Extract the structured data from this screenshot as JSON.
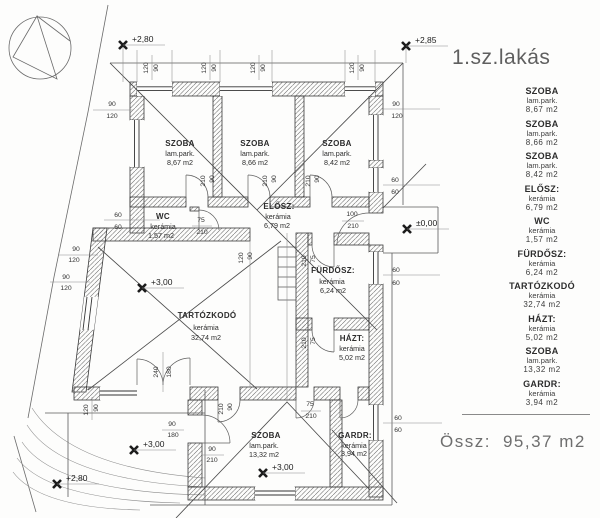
{
  "title": "1.sz.lakás",
  "total_label": "Össz:",
  "total_value": "95,37 m2",
  "legend": {
    "items": [
      {
        "name": "SZOBA",
        "material": "lam.park.",
        "area": "8,67 m2"
      },
      {
        "name": "SZOBA",
        "material": "lam.park.",
        "area": "8,66 m2"
      },
      {
        "name": "SZOBA",
        "material": "lam.park.",
        "area": "8,42 m2"
      },
      {
        "name": "ELŐSZ:",
        "material": "kerámia",
        "area": "6,79 m2"
      },
      {
        "name": "WC",
        "material": "kerámia",
        "area": "1,57 m2"
      },
      {
        "name": "FÜRDŐSZ:",
        "material": "kerámia",
        "area": "6,24 m2"
      },
      {
        "name": "TARTÓZKODÓ",
        "material": "kerámia",
        "area": "32,74 m2"
      },
      {
        "name": "HÁZT:",
        "material": "kerámia",
        "area": "5,02 m2"
      },
      {
        "name": "SZOBA",
        "material": "lam.park.",
        "area": "13,32 m2"
      },
      {
        "name": "GARDR:",
        "material": "kerámia",
        "area": "3,94 m2"
      }
    ]
  },
  "plan": {
    "elevations": [
      {
        "text": "+2,80",
        "x": 123,
        "y": 45
      },
      {
        "text": "+2,85",
        "x": 406,
        "y": 46
      },
      {
        "text": "±0,00",
        "x": 407,
        "y": 229
      },
      {
        "text": "+3,00",
        "x": 142,
        "y": 288
      },
      {
        "text": "+3,00",
        "x": 263,
        "y": 473
      },
      {
        "text": "+3,00",
        "x": 134,
        "y": 450
      },
      {
        "text": "+2,80",
        "x": 57,
        "y": 484
      }
    ],
    "labels": [
      {
        "k": "room-name",
        "t": "SZOBA",
        "x": 180,
        "y": 146
      },
      {
        "k": "room-material",
        "t": "lam.park.",
        "x": 180,
        "y": 156
      },
      {
        "k": "room-area",
        "t": "8,67  m2",
        "x": 180,
        "y": 165
      },
      {
        "k": "room-name",
        "t": "SZOBA",
        "x": 255,
        "y": 146
      },
      {
        "k": "room-material",
        "t": "lam.park.",
        "x": 255,
        "y": 156
      },
      {
        "k": "room-area",
        "t": "8,66  m2",
        "x": 255,
        "y": 165
      },
      {
        "k": "room-name",
        "t": "SZOBA",
        "x": 337,
        "y": 146
      },
      {
        "k": "room-material",
        "t": "lam.park.",
        "x": 337,
        "y": 156
      },
      {
        "k": "room-area",
        "t": "8,42  m2",
        "x": 337,
        "y": 165
      },
      {
        "k": "room-name",
        "t": "WC",
        "x": 163,
        "y": 219
      },
      {
        "k": "room-material",
        "t": "kerámia",
        "x": 163,
        "y": 229
      },
      {
        "k": "room-area",
        "t": "1,57  m2",
        "x": 161,
        "y": 238
      },
      {
        "k": "room-name",
        "t": "ELŐSZ:",
        "x": 279,
        "y": 209
      },
      {
        "k": "room-material",
        "t": "kerámia",
        "x": 278,
        "y": 219
      },
      {
        "k": "room-area",
        "t": "6,79  m2",
        "x": 277,
        "y": 228
      },
      {
        "k": "room-name",
        "t": "FÜRDŐSZ:",
        "x": 333,
        "y": 273
      },
      {
        "k": "room-material",
        "t": "kerámia",
        "x": 332,
        "y": 284
      },
      {
        "k": "room-area",
        "t": "6,24  m2",
        "x": 333,
        "y": 293
      },
      {
        "k": "room-name",
        "t": "TARTÓZKODÓ",
        "x": 207,
        "y": 318
      },
      {
        "k": "room-material",
        "t": "kerámia",
        "x": 206,
        "y": 330
      },
      {
        "k": "room-area",
        "t": "32,74  m2",
        "x": 206,
        "y": 340
      },
      {
        "k": "room-name",
        "t": "HÁZT:",
        "x": 352,
        "y": 341
      },
      {
        "k": "room-material",
        "t": "kerámia",
        "x": 352,
        "y": 351
      },
      {
        "k": "room-area",
        "t": "5,02  m2",
        "x": 352,
        "y": 360
      },
      {
        "k": "room-name",
        "t": "SZOBA",
        "x": 266,
        "y": 438
      },
      {
        "k": "room-material",
        "t": "lam.park.",
        "x": 264,
        "y": 448
      },
      {
        "k": "room-area",
        "t": "13,32  m2",
        "x": 264,
        "y": 457
      },
      {
        "k": "room-name",
        "t": "GARDR:",
        "x": 355,
        "y": 438
      },
      {
        "k": "room-material",
        "t": "kerámia",
        "x": 354,
        "y": 448
      },
      {
        "k": "room-area",
        "t": "3,94  m2",
        "x": 354,
        "y": 456
      },
      {
        "k": "dimension-label",
        "t": "120",
        "x": 148,
        "y": 68,
        "r": -90
      },
      {
        "k": "dimension-label",
        "t": "90",
        "x": 158,
        "y": 68,
        "r": -90
      },
      {
        "k": "dimension-label",
        "t": "120",
        "x": 206,
        "y": 68,
        "r": -90
      },
      {
        "k": "dimension-label",
        "t": "90",
        "x": 216,
        "y": 68,
        "r": -90
      },
      {
        "k": "dimension-label",
        "t": "120",
        "x": 255,
        "y": 68,
        "r": -90
      },
      {
        "k": "dimension-label",
        "t": "90",
        "x": 265,
        "y": 68,
        "r": -90
      },
      {
        "k": "dimension-label",
        "t": "120",
        "x": 354,
        "y": 68,
        "r": -90
      },
      {
        "k": "dimension-label",
        "t": "90",
        "x": 364,
        "y": 68,
        "r": -90
      },
      {
        "k": "dimension-label",
        "t": "90",
        "x": 396,
        "y": 106
      },
      {
        "k": "dimension-label",
        "t": "120",
        "x": 397,
        "y": 118
      },
      {
        "k": "dimension-label",
        "t": "60",
        "x": 395,
        "y": 182
      },
      {
        "k": "dimension-label",
        "t": "60",
        "x": 395,
        "y": 194
      },
      {
        "k": "dimension-label",
        "t": "60",
        "x": 396,
        "y": 272
      },
      {
        "k": "dimension-label",
        "t": "60",
        "x": 396,
        "y": 285
      },
      {
        "k": "dimension-label",
        "t": "60",
        "x": 398,
        "y": 420
      },
      {
        "k": "dimension-label",
        "t": "60",
        "x": 398,
        "y": 432
      },
      {
        "k": "dimension-label",
        "t": "90",
        "x": 112,
        "y": 106
      },
      {
        "k": "dimension-label",
        "t": "120",
        "x": 112,
        "y": 118
      },
      {
        "k": "dimension-label",
        "t": "60",
        "x": 118,
        "y": 217
      },
      {
        "k": "dimension-label",
        "t": "60",
        "x": 118,
        "y": 229
      },
      {
        "k": "dimension-label",
        "t": "90",
        "x": 76,
        "y": 251
      },
      {
        "k": "dimension-label",
        "t": "120",
        "x": 74,
        "y": 262
      },
      {
        "k": "dimension-label",
        "t": "90",
        "x": 66,
        "y": 279
      },
      {
        "k": "dimension-label",
        "t": "120",
        "x": 66,
        "y": 290
      },
      {
        "k": "dimension-label",
        "t": "120",
        "x": 88,
        "y": 410,
        "r": -90
      },
      {
        "k": "dimension-label",
        "t": "90",
        "x": 98,
        "y": 408,
        "r": -90
      },
      {
        "k": "dimension-label",
        "t": "90",
        "x": 172,
        "y": 426
      },
      {
        "k": "dimension-label",
        "t": "180",
        "x": 173,
        "y": 437
      },
      {
        "k": "dimension-label",
        "t": "90",
        "x": 212,
        "y": 451
      },
      {
        "k": "dimension-label",
        "t": "210",
        "x": 212,
        "y": 462
      },
      {
        "k": "door-size-label",
        "t": "75",
        "x": 201,
        "y": 222
      },
      {
        "k": "door-size-label",
        "t": "210",
        "x": 202,
        "y": 234
      },
      {
        "k": "door-size-label",
        "t": "100",
        "x": 352,
        "y": 216
      },
      {
        "k": "door-size-label",
        "t": "210",
        "x": 353,
        "y": 228
      },
      {
        "k": "door-size-label",
        "t": "75",
        "x": 310,
        "y": 406
      },
      {
        "k": "door-size-label",
        "t": "210",
        "x": 311,
        "y": 418
      },
      {
        "k": "door-size-label",
        "t": "210",
        "x": 306,
        "y": 261,
        "r": -90
      },
      {
        "k": "door-size-label",
        "t": "75",
        "x": 315,
        "y": 259,
        "r": -90
      },
      {
        "k": "door-size-label",
        "t": "210",
        "x": 306,
        "y": 343,
        "r": -90
      },
      {
        "k": "door-size-label",
        "t": "75",
        "x": 315,
        "y": 341,
        "r": -90
      },
      {
        "k": "door-size-label",
        "t": "210",
        "x": 205,
        "y": 181,
        "r": -90
      },
      {
        "k": "door-size-label",
        "t": "90",
        "x": 214,
        "y": 179,
        "r": -90
      },
      {
        "k": "door-size-label",
        "t": "210",
        "x": 267,
        "y": 181,
        "r": -90
      },
      {
        "k": "door-size-label",
        "t": "90",
        "x": 276,
        "y": 179,
        "r": -90
      },
      {
        "k": "door-size-label",
        "t": "210",
        "x": 310,
        "y": 181,
        "r": -90
      },
      {
        "k": "door-size-label",
        "t": "90",
        "x": 319,
        "y": 179,
        "r": -90
      },
      {
        "k": "door-size-label",
        "t": "210",
        "x": 223,
        "y": 409,
        "r": -90
      },
      {
        "k": "door-size-label",
        "t": "90",
        "x": 232,
        "y": 407,
        "r": -90
      },
      {
        "k": "door-size-label",
        "t": "240",
        "x": 158,
        "y": 372,
        "r": -90
      },
      {
        "k": "door-size-label",
        "t": "180",
        "x": 171,
        "y": 372,
        "r": -90
      },
      {
        "k": "dimension-label",
        "t": "120",
        "x": 243,
        "y": 258,
        "r": -90
      },
      {
        "k": "dimension-label",
        "t": "90",
        "x": 252,
        "y": 256,
        "r": -90
      }
    ]
  }
}
